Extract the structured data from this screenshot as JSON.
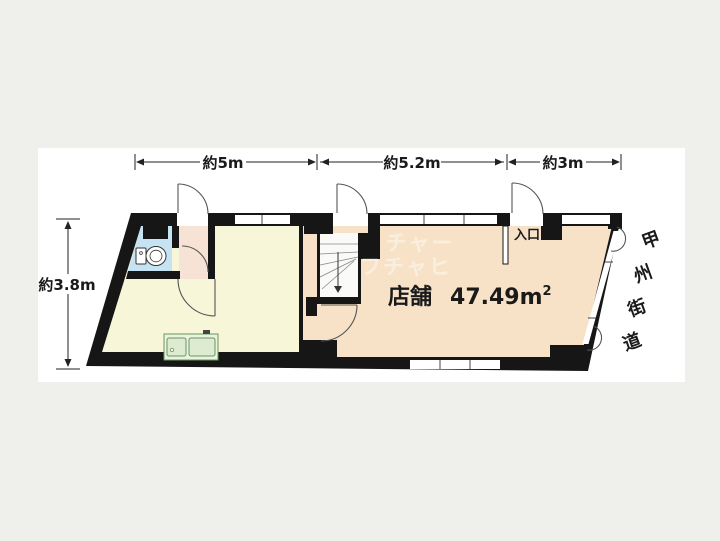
{
  "dimensions": {
    "top": [
      {
        "label": "約5m"
      },
      {
        "label": "約5.2m"
      },
      {
        "label": "約3m"
      }
    ],
    "left": {
      "label": "約3.8m"
    }
  },
  "rooms": {
    "shop_label": "店舗",
    "shop_area": "47.49m",
    "shop_area_sup": "2",
    "entrance_label": "入口"
  },
  "road": {
    "name": "甲州街道",
    "chars": [
      "甲",
      "州",
      "街",
      "道"
    ]
  },
  "watermark": {
    "line1": "チャー",
    "line2": "フチャヒ"
  },
  "colors": {
    "background": "#efefec",
    "panel": "#ffffff",
    "wall": "#161616",
    "room_left": "#f8f6d8",
    "room_shop": "#f8e2c7",
    "toilet": "#c5e3f2",
    "vestibule": "#f6e3d5",
    "kitchen_fill": "#ddecd0",
    "kitchen_stroke": "#6a955c"
  }
}
